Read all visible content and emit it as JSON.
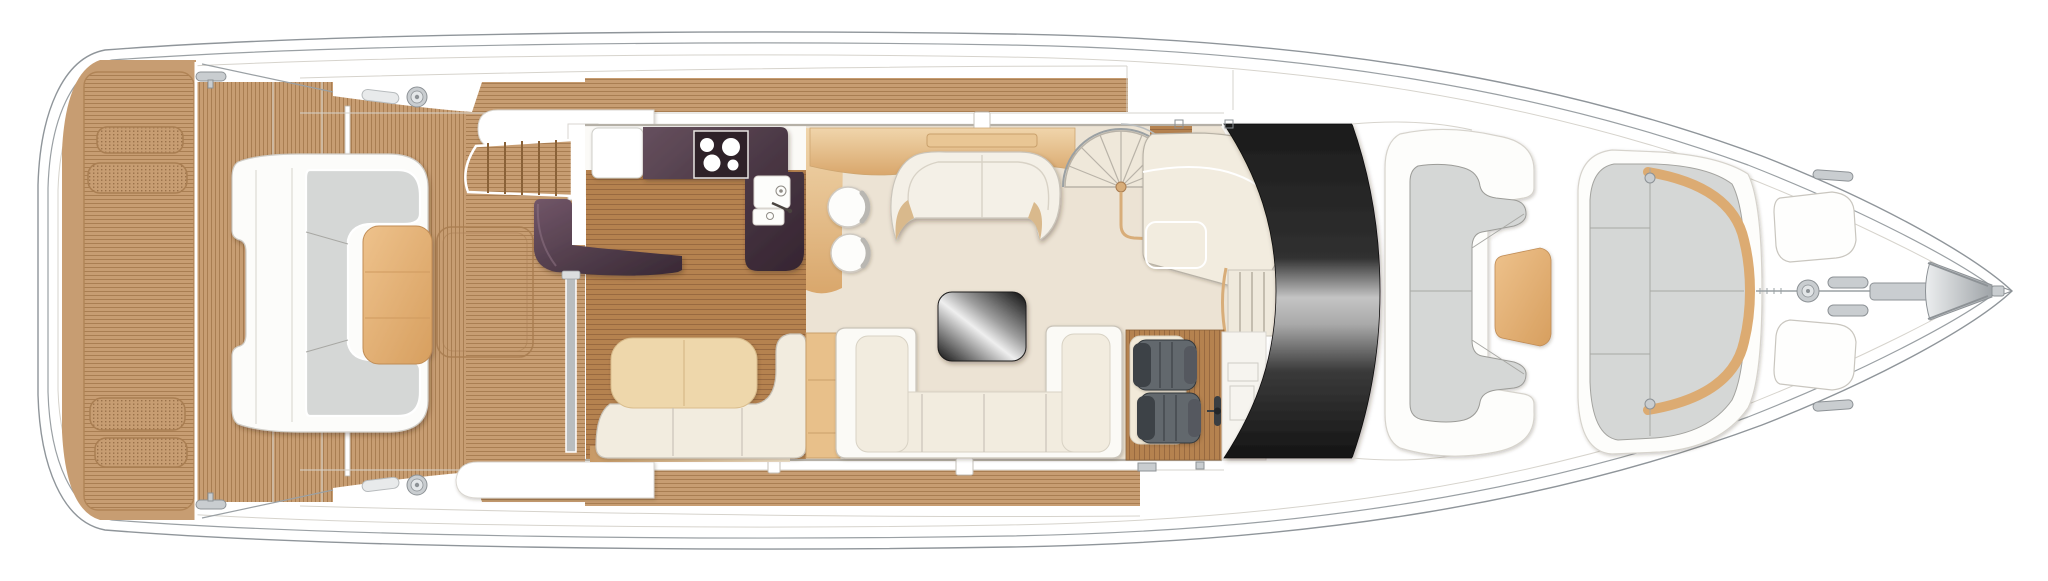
{
  "meta": {
    "subject": "motor yacht main deck floor plan",
    "view": "top-down plan",
    "orientation": "stern at left, bow pointing right",
    "canvas": {
      "width": 2048,
      "height": 581
    },
    "background": "#ffffff",
    "visible_text": "none"
  },
  "colors": {
    "hull_line": "#9aa0a4",
    "faint_line": "#d6d3cc",
    "teak_base": "#c79d72",
    "teak_line": "#a97e52",
    "teak_margin": "#b08456",
    "wood_base": "#b5824f",
    "wood_line": "#986940",
    "carpet": "#ece3d4",
    "interior_white": "#fbfaf7",
    "purple_dark": "#3f2e3a",
    "purple_mid": "#55404c",
    "purple_light": "#6e5565",
    "ivory": "#f2ecdf",
    "rim_white": "#fbfaf6",
    "seam": "#c9c3b8",
    "cushion_tan": "#eed7ab",
    "end_tan": "#e8c08a",
    "table_tan_light": "#eec28c",
    "table_tan_dark": "#d9a263",
    "sideboard_light": "#f0d5ab",
    "sideboard_dark": "#d9a76c",
    "cushion_gray": "#d5d7d6",
    "cushion_gray_line": "#9c9c98",
    "helm_seat": "#62686d",
    "helm_seat_dark": "#3e4347",
    "metal": "#c9cdd0",
    "metal_line": "#8d9296",
    "glass_black": "#1b1b1b",
    "glass_silver": "#c4c4c4"
  },
  "regions": {
    "stern": {
      "swim_platform": "teak bathing platform",
      "platform_hatch_count": 4,
      "transom_garage": "vertical-plank teak band"
    },
    "cockpit": {
      "sofa": "forward-facing C sofa, grey cushions on white base",
      "table": "teak cockpit table",
      "engine_hatch": "flush deck hatch outline",
      "canopy_pole_count": 2,
      "fuel_filler_count": 2
    },
    "side_decks": {
      "port": "teak walkway with white gunwale",
      "starboard": "teak walkway with white gunwale",
      "companionway_stairs": "teak steps to side deck, 6 treads"
    },
    "galley": {
      "worktop": "aubergine L-shaped counter",
      "cooktop_burners": 4,
      "sink": "double bowl with mixer tap",
      "bar_counter": "aubergine curved breakfast bar",
      "floor": "dark wood sole",
      "door_mullion": "grey sliding-door post"
    },
    "dinette": {
      "seat_cushions": 2,
      "backrest": "ivory wrap-around",
      "end_cabinet": "tan upholstered end unit"
    },
    "salon": {
      "carpet": "cream",
      "sideboard": "tan cabinet with vent panel",
      "side_tables": 2,
      "forward_sofa": "curved two-seat sofa",
      "coffee_table": "black glass table",
      "main_sofa": "U-shaped sofa, 4 seat sections"
    },
    "stairs": {
      "spiral_staircase": "radial treads to flybridge",
      "starboard_steps": "3 treads beside helm"
    },
    "helm": {
      "seats": 2,
      "steering_wheel": 1,
      "platform": "wood sole",
      "console": "outlined panels"
    },
    "windscreen": "black wrap-around glass with silver reflection band",
    "foredeck": {
      "observer_seating": "C-shaped grey settee",
      "table": "tan cocktail table",
      "sun_pad": "grey lounger pad with tan trim",
      "deck_hatch_count": 2,
      "mooring_cleat_count": 2
    },
    "ground_tackle": {
      "windlass": "vertical capstan",
      "chain": "centreline anchor chain",
      "anchor_chute": "stemhead anchor",
      "bow_rails": 2
    }
  }
}
